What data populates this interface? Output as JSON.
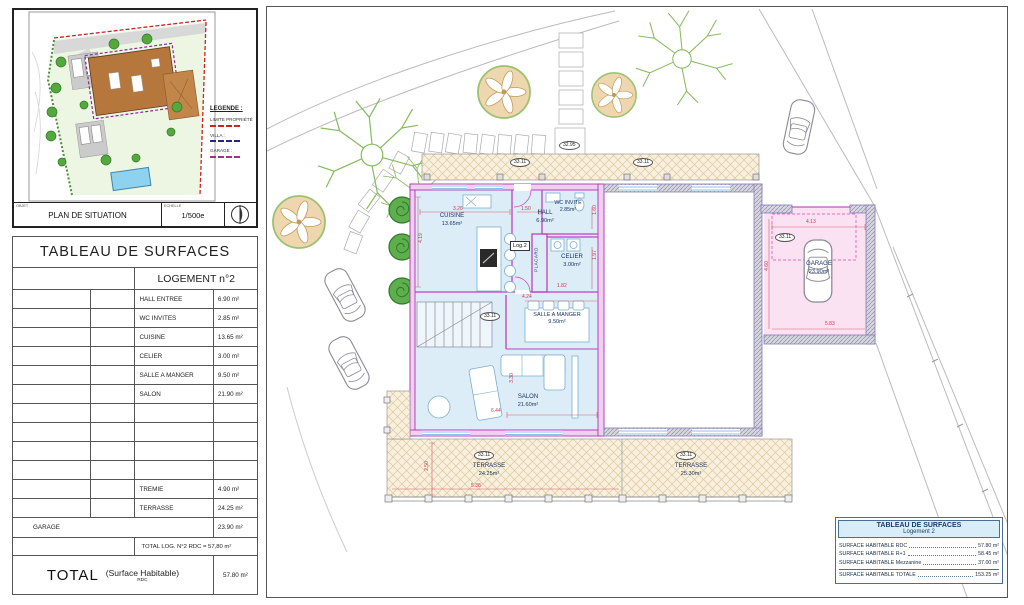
{
  "site_plan": {
    "object_label": "OBJET",
    "title": "PLAN DE SITUATION",
    "scale_label": "ECHELLE",
    "scale_value": "1/500e",
    "legend": {
      "title": "LEGENDE :",
      "items": [
        {
          "label": "LIMITE PROPRIÉTÉ",
          "color": "#cc2222"
        },
        {
          "label": "VILLA :",
          "color": "#26267e"
        },
        {
          "label": "GARAGE :",
          "color": "#a03090"
        }
      ]
    }
  },
  "surface_table": {
    "title": "TABLEAU DE SURFACES",
    "header": "LOGEMENT n°2",
    "rows": [
      {
        "label": "HALL ENTREE",
        "value": "6.90 m²"
      },
      {
        "label": "WC INVITES",
        "value": "2.85 m²"
      },
      {
        "label": "CUISINE",
        "value": "13.65 m²"
      },
      {
        "label": "CELIER",
        "value": "3.00 m²"
      },
      {
        "label": "SALLE A MANGER",
        "value": "9.50 m²"
      },
      {
        "label": "SALON",
        "value": "21.90 m²"
      },
      {
        "label": "",
        "value": ""
      },
      {
        "label": "",
        "value": ""
      },
      {
        "label": "",
        "value": ""
      },
      {
        "label": "",
        "value": ""
      },
      {
        "label": "TREMIE",
        "value": "4.90 m²"
      },
      {
        "label": "TERRASSE",
        "value": "24.25 m²"
      }
    ],
    "garage_row": {
      "label": "GARAGE",
      "value": "23.90 m²"
    },
    "subtotal": "TOTAL LOG. N°2 RDC = 57,80 m²",
    "total": {
      "label": "TOTAL",
      "sublabel": "(Surface Habitable)",
      "sublabel2": "RDC",
      "value": "57.80 m²"
    }
  },
  "floor_plan": {
    "unit_label": "Log.2",
    "placard": "PLACARD",
    "rooms": {
      "cuisine": {
        "name": "CUISINE",
        "area": "13.65m²"
      },
      "hall": {
        "name": "HALL",
        "area": "6.90m²"
      },
      "wc": {
        "name": "WC INVITE",
        "area": "2.85m²"
      },
      "celier": {
        "name": "CELIER",
        "area": "3.00m²"
      },
      "salle": {
        "name": "SALLE A MANGER",
        "area": "9.50m²"
      },
      "salon": {
        "name": "SALON",
        "area": "21.60m²"
      },
      "terrasse1": {
        "name": "TERRASSE",
        "area": "24.25m²"
      },
      "terrasse2": {
        "name": "TERRASSE",
        "area": "25.30m²"
      },
      "garage": {
        "name": "GARAGE",
        "area": "23.90m²"
      }
    },
    "markers": {
      "level_top": "32.95",
      "level_main": "33.11"
    },
    "dimensions": [
      "3.26",
      "1.50",
      "1.60",
      "4.19",
      "1.82",
      "1.97",
      "4.24",
      "3.30",
      "6.44",
      "2.50",
      "5.38",
      "4.13",
      "4.60",
      "5.83"
    ],
    "colors": {
      "wall_magenta": "#c040c0",
      "room_fill": "#dcedf8",
      "terrace_fill": "#f8f0dd",
      "garage_fill": "#fbe2f2",
      "dimension_red": "#c23a4e"
    }
  },
  "summary_table": {
    "title": "TABLEAU DE SURFACES",
    "subtitle": "Logement 2",
    "rows": [
      {
        "label": "SURFACE HABITABLE RDC",
        "value": "57.80 m²"
      },
      {
        "label": "SURFACE HABITABLE R+1",
        "value": "58.45 m²"
      },
      {
        "label": "SURFACE HABITABLE Mezzanine",
        "value": "37.00 m²"
      },
      {
        "label": "SURFACE HABITABLE TOTALE",
        "value": "153.25 m²"
      }
    ]
  }
}
